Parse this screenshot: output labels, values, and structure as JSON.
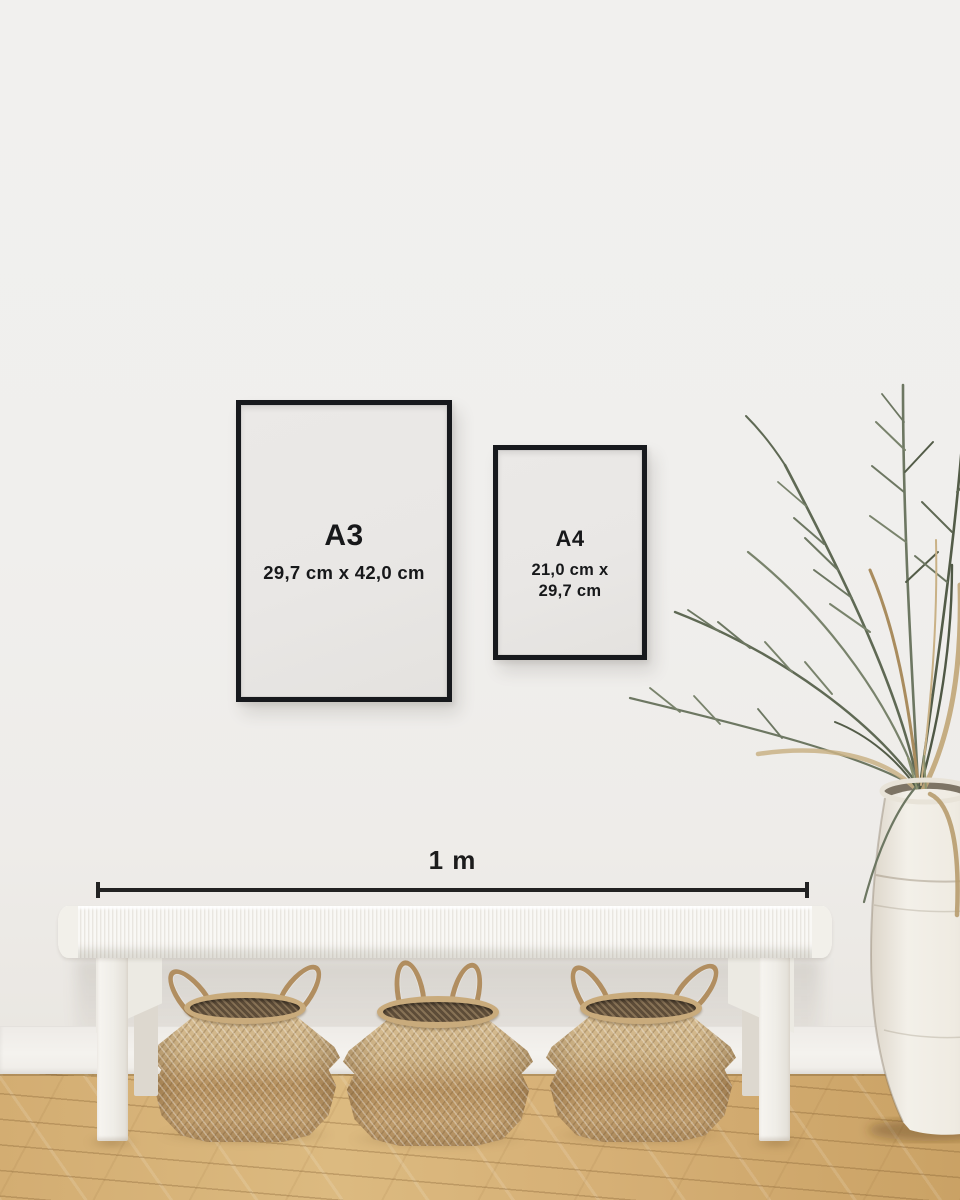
{
  "frames": {
    "a3": {
      "label": "A3",
      "dimensions": "29,7 cm x 42,0 cm"
    },
    "a4": {
      "label": "A4",
      "dimensions_line1": "21,0 cm x",
      "dimensions_line2": "29,7 cm"
    }
  },
  "scale": {
    "label": "1 m"
  },
  "palette": {
    "frame_border": "#17191d",
    "text": "#17181a",
    "wall": "#f0efed",
    "baseboard": "#f4f2ee",
    "floor_light": "#dcba80",
    "floor_dark": "#caa265",
    "bench_white": "#f6f4f0",
    "basket_tan": "#c3a377",
    "basket_interior": "#5d4c38",
    "plant_green": "#5f6954",
    "plant_dried": "#c0a577",
    "vase_cream": "#efebe3"
  }
}
